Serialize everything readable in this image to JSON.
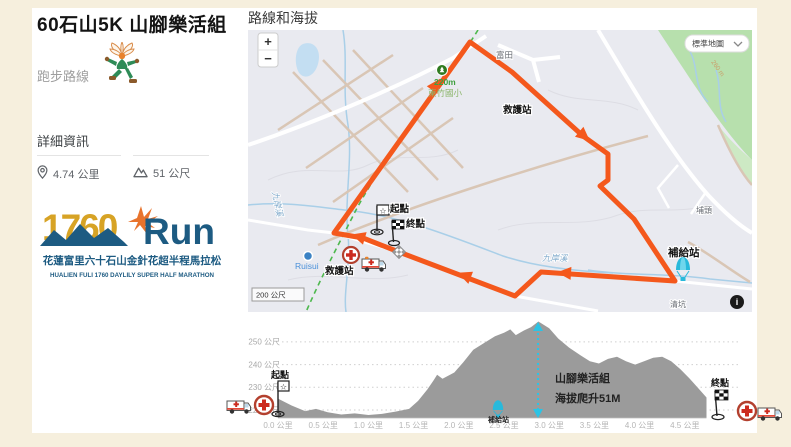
{
  "colors": {
    "page_bg": "#f6efdd",
    "route_orange": "#f4581c",
    "map_cyan": "#28b9db",
    "area_gray": "#9b9b9b",
    "logo_gold": "#d7a325",
    "logo_blue": "#1d5b82",
    "aid_red": "#cc2b1f",
    "rail_green": "#4db84d"
  },
  "sidebar": {
    "title": "60石山5K 山腳樂活組",
    "route_type_label": "跑步路線",
    "details_heading": "詳細資訊",
    "distance_value": "4.74 公里",
    "elevation_value": "51 公尺",
    "logo": {
      "big_num": "1760",
      "big_text": "Run",
      "line_zh": "花蓮富里六十石山金針花超半程馬拉松",
      "line_en": "HUALIEN FULI 1760 DAYLILY SUPER HALF MARATHON"
    }
  },
  "map_panel": {
    "heading": "路線和海拔",
    "controls": {
      "zoom_in": "+",
      "zoom_out": "−",
      "map_type": "標準地圖"
    },
    "scale_label": "200 公尺",
    "info_glyph": "i",
    "labels": {
      "futian": "富田",
      "school_dist": "220m",
      "school_name": "東竹國小",
      "aid_top": "救護站",
      "putou": "埔頭",
      "supply": "補給站",
      "qingkeng": "清坑",
      "river_main": "九岸溪",
      "river_left": "九岸溪",
      "ruisui": "Ruisui",
      "aid_bottom": "救護站",
      "start": "起點",
      "finish": "終點",
      "contour": "260 m"
    },
    "route": {
      "color": "#f4581c",
      "points": [
        [
          222,
          12
        ],
        [
          264,
          42
        ],
        [
          335,
          106
        ],
        [
          360,
          124
        ],
        [
          360,
          150
        ],
        [
          352,
          156
        ],
        [
          386,
          189
        ],
        [
          427,
          251
        ],
        [
          293,
          242
        ],
        [
          267,
          266
        ],
        [
          151,
          222
        ],
        [
          115,
          208
        ],
        [
          86,
          203
        ],
        [
          222,
          12
        ]
      ],
      "arrows": [
        {
          "x": 187,
          "y": 56,
          "a": -54.6
        },
        {
          "x": 335,
          "y": 105,
          "a": 40.5
        },
        {
          "x": 318,
          "y": 243,
          "a": 183.8
        },
        {
          "x": 218,
          "y": 246,
          "a": 200.8
        },
        {
          "x": 112,
          "y": 207,
          "a": 196.3
        }
      ]
    }
  },
  "chart_data": {
    "type": "area",
    "title": "路線和海拔",
    "x_unit": "公里",
    "y_unit": "公尺",
    "ylim": [
      216,
      261
    ],
    "xlim": [
      0,
      4.74
    ],
    "grid": "dotted-horizontal",
    "y_gridlines": [
      {
        "m": 250,
        "label": "250 公尺"
      },
      {
        "m": 240,
        "label": "240 公尺"
      },
      {
        "m": 230,
        "label": "230 公尺"
      },
      {
        "m": 220,
        "label": "220 公尺"
      }
    ],
    "x_ticks": [
      {
        "km": 0.0,
        "label": "0.0 公里"
      },
      {
        "km": 0.5,
        "label": "0.5 公里"
      },
      {
        "km": 1.0,
        "label": "1.0 公里"
      },
      {
        "km": 1.5,
        "label": "1.5 公里"
      },
      {
        "km": 2.0,
        "label": "2.0 公里"
      },
      {
        "km": 2.5,
        "label": "2.5 公里"
      },
      {
        "km": 3.0,
        "label": "3.0 公里"
      },
      {
        "km": 3.5,
        "label": "3.5 公里"
      },
      {
        "km": 4.0,
        "label": "4.0 公里"
      },
      {
        "km": 4.5,
        "label": "4.5 公里"
      }
    ],
    "profile": [
      [
        0.0,
        225
      ],
      [
        0.15,
        222
      ],
      [
        0.3,
        219.5
      ],
      [
        0.42,
        220.5
      ],
      [
        0.55,
        219
      ],
      [
        0.7,
        218
      ],
      [
        0.85,
        218.5
      ],
      [
        1.0,
        217.8
      ],
      [
        1.15,
        218.3
      ],
      [
        1.3,
        219.3
      ],
      [
        1.45,
        220.5
      ],
      [
        1.55,
        224
      ],
      [
        1.65,
        229
      ],
      [
        1.72,
        233
      ],
      [
        1.76,
        235.5
      ],
      [
        1.82,
        233.8
      ],
      [
        1.95,
        236.5
      ],
      [
        2.05,
        241
      ],
      [
        2.16,
        246.5
      ],
      [
        2.28,
        249.5
      ],
      [
        2.4,
        252.5
      ],
      [
        2.5,
        254
      ],
      [
        2.57,
        255.5
      ],
      [
        2.63,
        253
      ],
      [
        2.72,
        255
      ],
      [
        2.8,
        256.5
      ],
      [
        2.88,
        259
      ],
      [
        3.0,
        256
      ],
      [
        3.1,
        251.5
      ],
      [
        3.22,
        247.5
      ],
      [
        3.35,
        244
      ],
      [
        3.45,
        241.5
      ],
      [
        3.55,
        240.5
      ],
      [
        3.65,
        242.5
      ],
      [
        3.75,
        243.5
      ],
      [
        3.85,
        241.5
      ],
      [
        3.95,
        240
      ],
      [
        4.05,
        241.5
      ],
      [
        4.15,
        243
      ],
      [
        4.25,
        243.5
      ],
      [
        4.35,
        241.5
      ],
      [
        4.45,
        238
      ],
      [
        4.55,
        234
      ],
      [
        4.65,
        229.5
      ],
      [
        4.74,
        225.5
      ]
    ],
    "annotations": {
      "start": "起點",
      "finish": "終點",
      "supply": "補給站",
      "climb_marker_km": 2.88,
      "group_line1": "山腳樂活組",
      "group_line2": "海拔爬升51M"
    }
  }
}
